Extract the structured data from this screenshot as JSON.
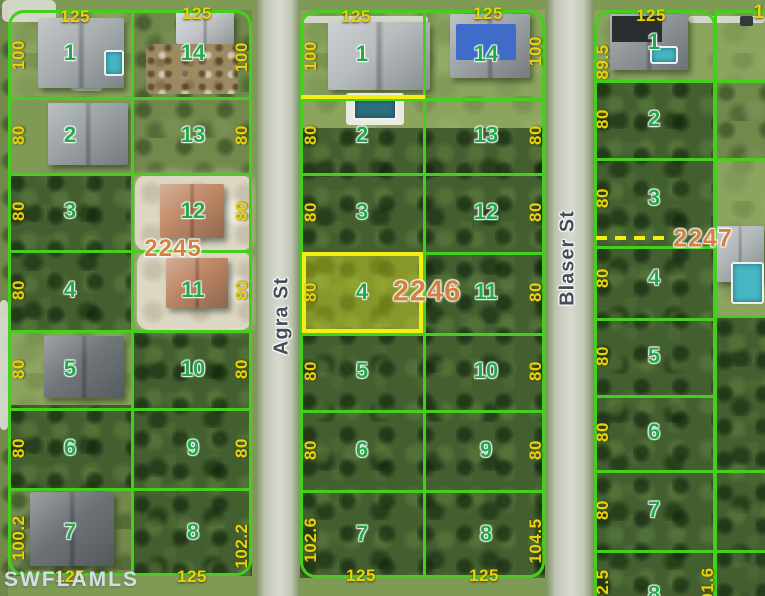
{
  "watermark": "SWFLAMLS",
  "streets": {
    "agra": "Agra St",
    "blaser": "Blaser St"
  },
  "parcel_labels": {
    "left": "2245",
    "middle": "2246",
    "right": "2247"
  },
  "edge_partial_label": "1",
  "colors": {
    "line": "#45ce1e",
    "dim": "#e8d309",
    "lot": "#21a94b",
    "parcel": "#d2823e",
    "hl": "#f2ef12"
  },
  "blocks": {
    "left": {
      "top_dims": [
        "125",
        "125"
      ],
      "bottom_dims": [
        "125",
        "125"
      ],
      "west_dims": [
        "100",
        "80",
        "80",
        "80",
        "80",
        "80",
        "100.2"
      ],
      "east_dims": [
        "100",
        "80",
        "80",
        "80",
        "80",
        "80",
        "102.2"
      ],
      "west_lots": [
        "1",
        "2",
        "3",
        "4",
        "5",
        "6",
        "7"
      ],
      "east_lots": [
        "14",
        "13",
        "12",
        "11",
        "10",
        "9",
        "8"
      ]
    },
    "middle": {
      "top_dims": [
        "125",
        "125"
      ],
      "bottom_dims": [
        "125",
        "125"
      ],
      "west_dims": [
        "100",
        "80",
        "80",
        "80",
        "80",
        "80",
        "102.6"
      ],
      "east_dims": [
        "100",
        "80",
        "80",
        "80",
        "80",
        "80",
        "104.5"
      ],
      "west_lots": [
        "1",
        "2",
        "3",
        "4",
        "5",
        "6",
        "7"
      ],
      "east_lots": [
        "14",
        "13",
        "12",
        "11",
        "10",
        "9",
        "8"
      ],
      "highlighted_lot": "4"
    },
    "right": {
      "top_dims": [
        "125"
      ],
      "west_dims": [
        "89.5",
        "80",
        "80",
        "80",
        "80",
        "80",
        "80",
        "102.5"
      ],
      "east_dims": [
        "101.6"
      ],
      "lots": [
        "1",
        "2",
        "3",
        "4",
        "5",
        "6",
        "7",
        "8"
      ]
    }
  }
}
